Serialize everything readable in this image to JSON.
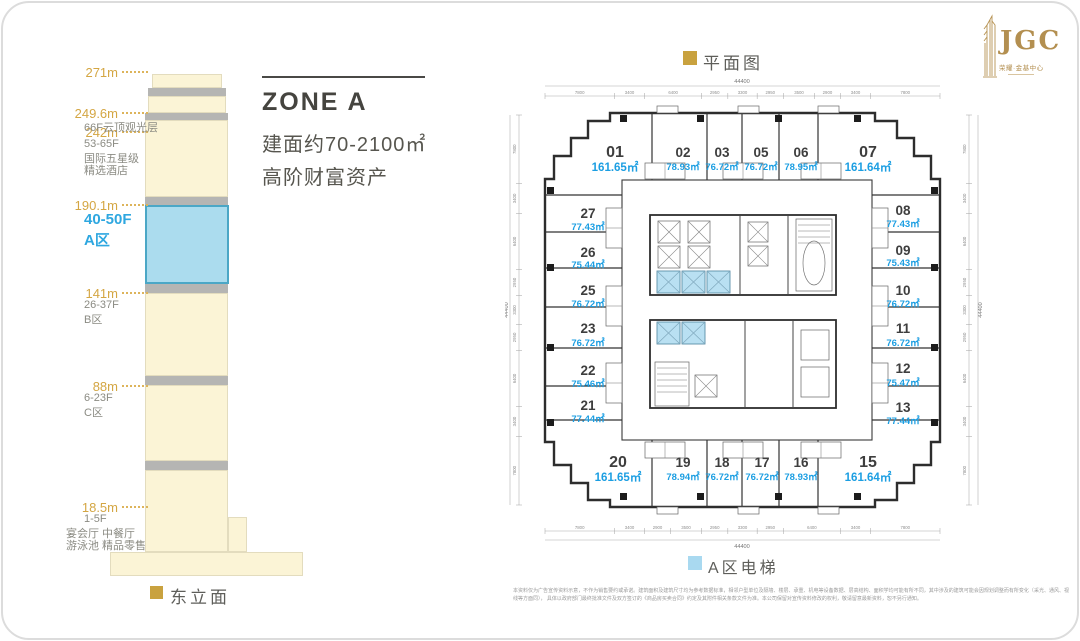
{
  "logo": {
    "name": "JGC",
    "subtitle": "荣耀·金基中心"
  },
  "zone_panel": {
    "title": "ZONE A",
    "line1": "建面约70-2100㎡",
    "line2": "高阶财富资产"
  },
  "elevation": {
    "caption": "东立面",
    "markers": [
      {
        "height": "271m",
        "lines": []
      },
      {
        "height": "249.6m",
        "lines": [
          "66F云顶观光层"
        ]
      },
      {
        "height": "242m",
        "lines": [
          "53-65F",
          "国际五星级",
          "精选酒店"
        ]
      },
      {
        "height": "190.1m",
        "lines": [
          "40-50F",
          "A区"
        ]
      },
      {
        "height": "141m",
        "lines": [
          "26-37F",
          "B区"
        ]
      },
      {
        "height": "88m",
        "lines": [
          "6-23F",
          "C区"
        ]
      },
      {
        "height": "18.5m",
        "lines": [
          "1-5F",
          "宴会厅 中餐厅",
          "游泳池 精品零售"
        ]
      }
    ],
    "zone_a_color": "#ABDCEE",
    "gold_color": "#D4A643"
  },
  "plan": {
    "title": "平面图",
    "legend": "A区电梯",
    "legend_color": "#A9D9F0",
    "title_square_color": "#C9A23F",
    "units": [
      {
        "no": "01",
        "area": "161.65㎡"
      },
      {
        "no": "02",
        "area": "78.93㎡"
      },
      {
        "no": "03",
        "area": "76.72㎡"
      },
      {
        "no": "05",
        "area": "76.72㎡"
      },
      {
        "no": "06",
        "area": "78.95㎡"
      },
      {
        "no": "07",
        "area": "161.64㎡"
      },
      {
        "no": "08",
        "area": "77.43㎡"
      },
      {
        "no": "09",
        "area": "75.43㎡"
      },
      {
        "no": "10",
        "area": "76.72㎡"
      },
      {
        "no": "11",
        "area": "76.72㎡"
      },
      {
        "no": "12",
        "area": "75.47㎡"
      },
      {
        "no": "13",
        "area": "77.44㎡"
      },
      {
        "no": "15",
        "area": "161.64㎡"
      },
      {
        "no": "16",
        "area": "78.93㎡"
      },
      {
        "no": "17",
        "area": "76.72㎡"
      },
      {
        "no": "18",
        "area": "76.72㎡"
      },
      {
        "no": "19",
        "area": "78.94㎡"
      },
      {
        "no": "20",
        "area": "161.65㎡"
      },
      {
        "no": "21",
        "area": "77.44㎡"
      },
      {
        "no": "22",
        "area": "75.46㎡"
      },
      {
        "no": "23",
        "area": "76.72㎡"
      },
      {
        "no": "25",
        "area": "76.72㎡"
      },
      {
        "no": "26",
        "area": "75.44㎡"
      },
      {
        "no": "27",
        "area": "77.43㎡"
      }
    ],
    "dims": {
      "total": "44400",
      "top": [
        7800,
        3400,
        6400,
        2950,
        3300,
        2950,
        3500,
        2900,
        3400,
        7800
      ],
      "bottom": [
        7800,
        3400,
        2900,
        3500,
        2950,
        3300,
        2950,
        6400,
        3400,
        7800
      ],
      "left": [
        7800,
        3400,
        6400,
        2950,
        3300,
        2950,
        6400,
        3400,
        7800
      ],
      "right": [
        7800,
        3400,
        6400,
        2950,
        3300,
        2950,
        6400,
        3400,
        7800
      ]
    }
  },
  "disclaimer": {
    "line1": "本资料仅为广告宣传资料示意，不作为销售要约或承诺。建筑面积及建筑尺寸均为参考数据标准，相邻户型单位及隔墙、楼层、承重、机电等设备数据、层高结构、面积学均可能有所不同，其中涉及的建筑可能会因规划调整而有所变化（采光、通风、视线等方面同），",
    "line2": "具体以政府部门最终批准文件及双方签订的《商品房买卖合同》约定及其附件相关条款文件为准。本公司保留对宣传资料修改的权利，敬请留意最新资料，恕不另行通知。"
  }
}
